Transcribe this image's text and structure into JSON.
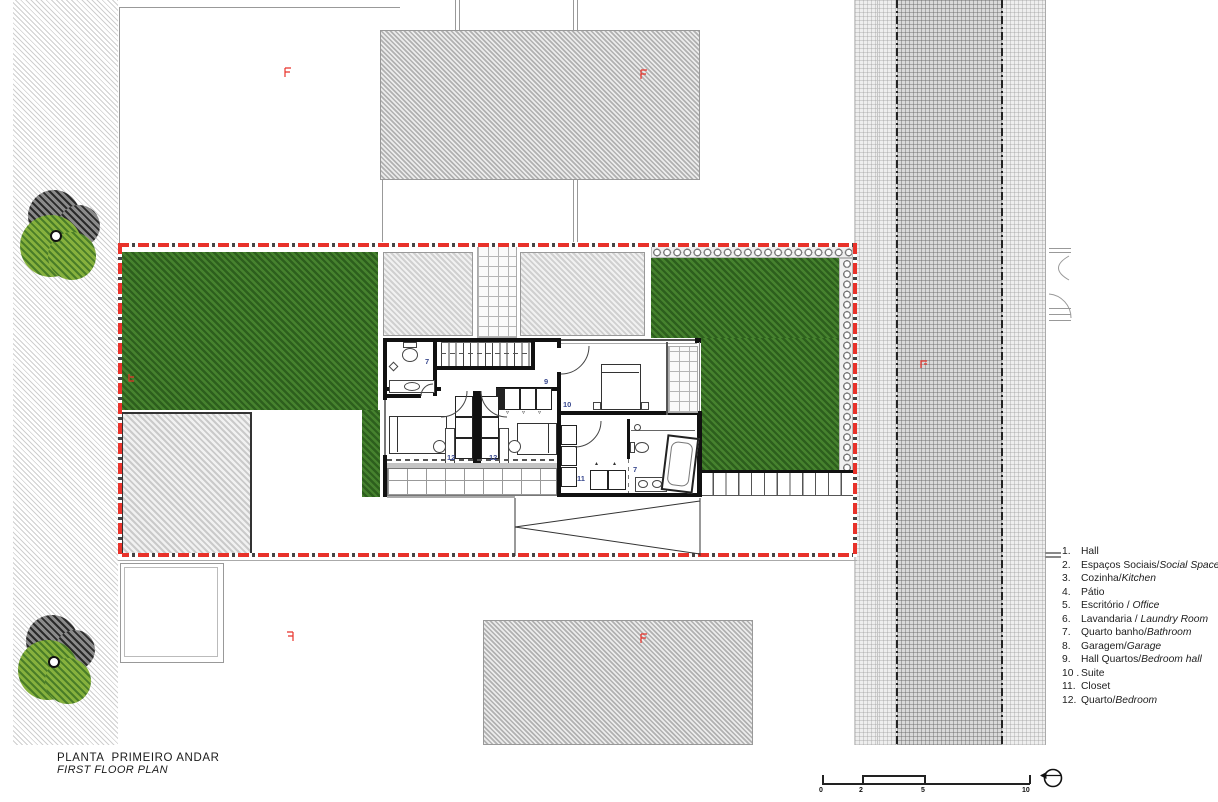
{
  "title": {
    "pt": "PLANTA  PRIMEIRO ANDAR",
    "en": "FIRST FLOOR PLAN"
  },
  "legend": {
    "items": [
      {
        "num": "1.",
        "pt": "Hall",
        "en": ""
      },
      {
        "num": "2.",
        "pt": "Espaços Sociais/",
        "en": "Social Spaces"
      },
      {
        "num": "3.",
        "pt": "Cozinha/",
        "en": "Kitchen"
      },
      {
        "num": "4.",
        "pt": "Pátio",
        "en": ""
      },
      {
        "num": "5.",
        "pt": "Escritório / ",
        "en": "Office"
      },
      {
        "num": "6.",
        "pt": "Lavandaria / ",
        "en": "Laundry Room"
      },
      {
        "num": "7.",
        "pt": "Quarto banho/",
        "en": "Bathroom"
      },
      {
        "num": "8.",
        "pt": "Garagem/",
        "en": "Garage"
      },
      {
        "num": "9.",
        "pt": "Hall Quartos/",
        "en": "Bedroom hall"
      },
      {
        "num": "10 .",
        "pt": "Suite",
        "en": ""
      },
      {
        "num": "11.",
        "pt": "Closet",
        "en": ""
      },
      {
        "num": "12.",
        "pt": "Quarto/",
        "en": "Bedroom"
      }
    ]
  },
  "scalebar": {
    "ticks": [
      "0",
      "2",
      "5",
      "10"
    ]
  },
  "room_labels": {
    "bath_upper": "7",
    "hall": "9",
    "suite": "10",
    "closet": "11",
    "bedroom_left": "12",
    "bedroom_right": "12",
    "bath_suite": "7"
  },
  "colors": {
    "boundary_red": "#e8322a",
    "lawn_green": "#3e7a28",
    "wall_black": "#111111",
    "hatch_gray": "#c9c9c9",
    "label_blue": "#3a4a8f"
  }
}
